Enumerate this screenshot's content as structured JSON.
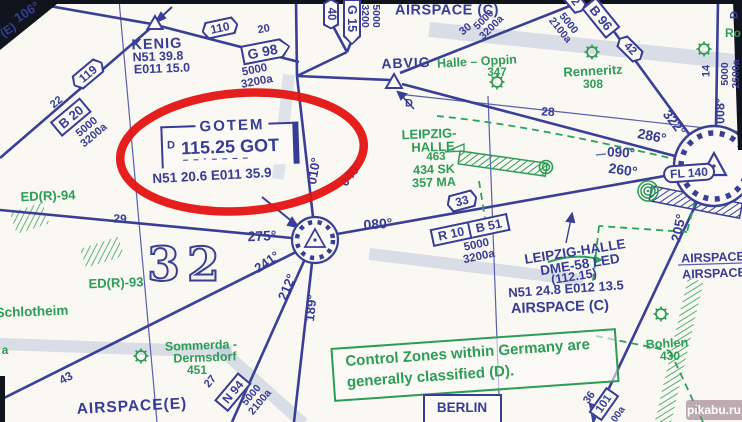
{
  "watermark": "pikabu.ru",
  "airspace_labels": {
    "top_c": "AIRSPACE (C)",
    "mid_c": "AIRSPACE (C)",
    "right_1": "AIRSPACE",
    "right_2": "AIRSPACE",
    "e": "AIRSPACE(E)"
  },
  "note_box": {
    "line1": "Control Zones within Germany are",
    "line2": "generally classified (D)."
  },
  "berlin_box": "BERLIN",
  "navaids": {
    "gotem": {
      "name": "GOTEM",
      "dme": "D",
      "freq": "115.25 GOT",
      "morse": "– – ·   – – –   –",
      "coords": "N51 20.6 E011 35.9"
    },
    "kenig": {
      "name": "KENIG",
      "lat": "N51 39.8",
      "lon": "E011 15.0"
    },
    "abvig": {
      "name": "ABVIG"
    },
    "leipzig_dme": {
      "name": "LEIPZIG-HALLE",
      "type": "DME-58 LED",
      "freq": "(112.15)",
      "coords": "N51 24.8 E012 13.5"
    }
  },
  "airport": {
    "name1": "LEIPZIG-",
    "name2": "HALLE",
    "elev": "463",
    "f1": "434 SK",
    "f2": "357 MA",
    "fl": "FL 140"
  },
  "places": {
    "halle_oppin": "Halle – Oppin",
    "halle_oppin_elev": "347",
    "renneritz": "Renneritz",
    "renneritz_elev": "308",
    "bohlen": "Bohlen",
    "bohlen_elev": "430",
    "schlotheim": "Schlotheim",
    "a_frag": "a",
    "ro_frag": "Ro",
    "sommerda1": "Sommerda -",
    "sommerda2": "Dermsdorf",
    "sommerda_elev": "451"
  },
  "restricted": {
    "r94": "ED(R)-94",
    "r93": "ED(R)-93"
  },
  "grid": {
    "big": "32"
  },
  "airways": {
    "a110": "110",
    "a119": "119",
    "b20": "B 20",
    "b20_dist": "22",
    "b20_alt": "5000\n3200a",
    "g98": "G 98",
    "g98_dist": "20",
    "g98_alt": "5000\n3200a",
    "a40": "40",
    "g15": "G 15",
    "g15_alt": "5000\n3200",
    "ne_dist": "30",
    "ne_alt": "5000\n3200a",
    "b96": "B 96",
    "b96_frag": "2",
    "b96_alt": "5000\n2100a",
    "a42": "42",
    "r008_alt": "5000\n2600a",
    "dist14": "14",
    "d_top": "D",
    "d_abvig": "D",
    "r10": "R 10",
    "b51": "B 51",
    "r10_alt": "5000\n3200a",
    "a33": "33",
    "n94": "N 94",
    "n94_dist": "27",
    "n94_alt": "5000\n2100a",
    "a101": "101",
    "a101_dist": "36",
    "a101_alt": "00a",
    "dist28": "28",
    "dist29": "29",
    "dist43": "43"
  },
  "radials": {
    "r106": "106°",
    "e_label": "(E)",
    "r010": "010°",
    "r040": "040°",
    "r080": "080°",
    "r275": "275°",
    "r241": "241°",
    "r212": "212°",
    "r189": "189°",
    "r286": "286°",
    "r322": "322°",
    "r205": "205°",
    "r090": "090°",
    "r260": "260°",
    "r008": "008°"
  },
  "colors": {
    "blue": "#373c95",
    "green": "#2d9c55",
    "red": "#e41312"
  }
}
